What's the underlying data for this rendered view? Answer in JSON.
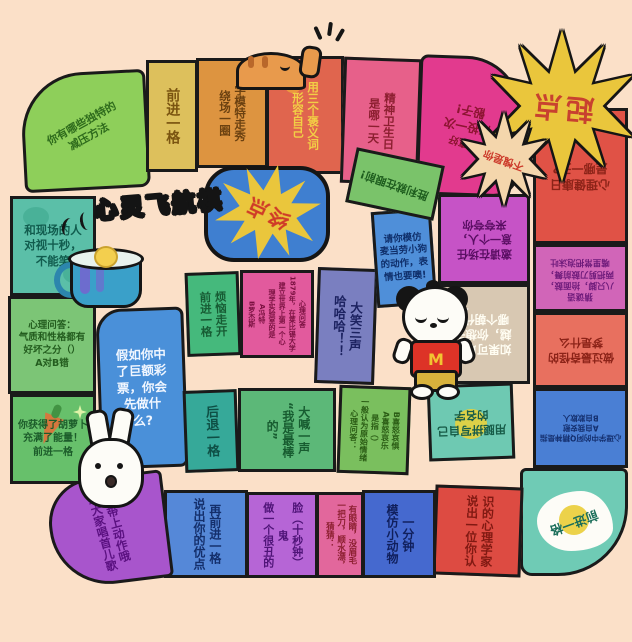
{
  "board": {
    "title": "心灵飞航棋",
    "background_color": "#fbe0c8",
    "outline_color": "#1a1a1a"
  },
  "start": {
    "label": "起点",
    "star_color": "#eac63c",
    "text_color": "#c8412f"
  },
  "finish": {
    "label": "终点",
    "box_color": "#3f7fd0",
    "star_color": "#eac63c",
    "text_color": "#cf3b28"
  },
  "badges": {
    "praise": "不愧是你",
    "praise_star_color": "#f4d6ac"
  },
  "decor": {
    "dog_shirt_letter": "M",
    "icons": [
      "teacup-icon",
      "steam-icon",
      "rabbit-icon",
      "mcdonalds-dog-icon",
      "cat-icon",
      "paw-print-icon",
      "sparkle-icon",
      "carrot-icon",
      "cloud-blob"
    ]
  },
  "tiles": {
    "destress": {
      "label": "你有哪些独特的\n减压方法",
      "color": "#8ecf5a"
    },
    "forward_top": {
      "label": "前进一格",
      "color": "#ddc05c"
    },
    "model_walk": {
      "label": "学模特走秀\n绕场一圈",
      "color": "#dd9440"
    },
    "praise_self": {
      "label": "用三个褒义词\n形容自己",
      "color": "#e0654e"
    },
    "mental_hygiene_day": {
      "label": "精神卫生日\n是哪一天",
      "color": "#e7608a"
    },
    "lucky": {
      "label": "运气真好",
      "label2": "再投一次\n骰子!",
      "color": "#e23a8e"
    },
    "mental_health_day": {
      "label": "心理健康日\n是哪一天?",
      "color": "#e05246"
    },
    "riddle_crab": {
      "label": "猜谜语\n八只脚，抬面鼓，\n两把剪刀鼓前舞，\n嘴里常把泡沫吐",
      "color": "#d165b8"
    },
    "strange_dream": {
      "label": "做过最奇怪的\n梦是什么",
      "color": "#e8705f"
    },
    "ah_q": {
      "label": "心理学中的阿Q精神是指\nA自我安慰\nB自欺欺人",
      "color": "#4a7fd4"
    },
    "forward_corner": {
      "label": "前进一格",
      "color": "#6fcbb5"
    },
    "psychologist": {
      "label": "说出一位你认\n识的心理学家",
      "color": "#dd4b42"
    },
    "mimic_animal": {
      "label": "模仿小动物\n一分钟",
      "color": "#4569cf"
    },
    "riddle_fish": {
      "label": "猜猜：\n一把刀，顺水漂，\n有眼睛，没眉毛",
      "color": "#e2679c"
    },
    "ugly_face": {
      "label": "做一个很丑的鬼\n脸（十秒钟）",
      "color": "#b665d6"
    },
    "strengths": {
      "label": "说出你的优点\n再前进一格",
      "color": "#5588d8"
    },
    "nursery_rhyme": {
      "label": "给大家唱首儿歌\n要带上动作哦",
      "color": "#a855cc"
    },
    "carrot": {
      "label": "你获得了胡萝卜\n充满了能量！\n前进一格",
      "color": "#67c06b"
    },
    "quiz_temperament": {
      "label": "心理问答：\n气质和性格都有\n好坏之分（）\nA对B错",
      "color": "#7cc576"
    },
    "stare": {
      "label": "和现场的人\n对视十秒，\n不能笑",
      "color": "#5bbfa8"
    },
    "lottery": {
      "label": "假如你中\n了巨额彩\n票，你会\n先做什\n么?",
      "color": "#4a90d9"
    },
    "worries": {
      "label": "烦恼走开\n前进一格",
      "color": "#45b97c"
    },
    "quiz_1879": {
      "label": "心理问答\n1879年，在莱比锡大学\n建立世界上第一个心\n理学实验室的是\nA冯特\nB罗杰斯",
      "color": "#e25a9d"
    },
    "laugh_three": {
      "label": "大笑三声\n哈哈哈！！",
      "color": "#7a7fc0"
    },
    "backward": {
      "label": "后退一格",
      "color": "#36a999"
    },
    "shout_best": {
      "label": "大喊一声\n“我是最棒的”",
      "color": "#5cb878"
    },
    "quiz_emotion": {
      "label": "心理问答：\n一般认为原始情绪\n是指（）\nA喜怒哀乐\nB喜怒哀惧",
      "color": "#7abf5e"
    },
    "spell_name": {
      "label": "用腿拼写自己\n的名字",
      "color": "#6ec9b2"
    },
    "invite_praise": {
      "label": "邀请在场任\n意一个人，\n来夸夸你",
      "color": "#c653c6"
    },
    "dynasty": {
      "label": "如果可以穿\n越，你想去\n哪个朝代?",
      "color": "#d8c8b2"
    },
    "mcdog": {
      "label": "请你模仿\n麦当劳小狗\n的动作，表\n情也要噢!",
      "color": "#4f8fd9"
    },
    "victory": {
      "label": "胜利就在眼前!",
      "color": "#7ac36a"
    }
  }
}
